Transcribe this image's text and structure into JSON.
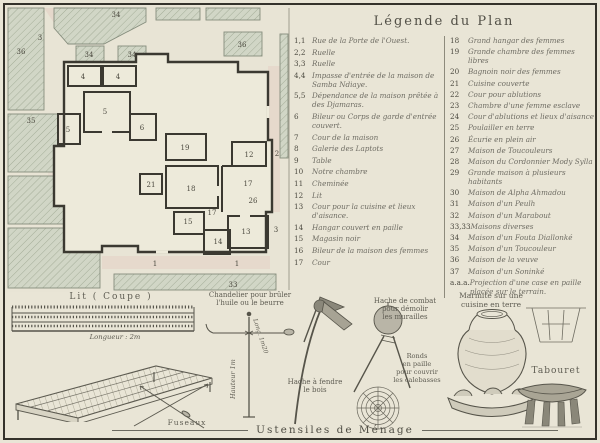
{
  "colors": {
    "paper": "#e9e5d6",
    "frame_ink": "#34322b",
    "legend_ink": "#6f6d64",
    "plan_wall_ink": "#3b3931",
    "hatch_fill": "#d1d6c6",
    "hatch_line": "#9fa893",
    "street_pink": "#e3cfc4"
  },
  "legend": {
    "title": "Légende du Plan",
    "left": [
      {
        "num": "1,1",
        "text": "Rue de la Porte de l'Ouest."
      },
      {
        "num": "2,2",
        "text": "Ruelle"
      },
      {
        "num": "3,3",
        "text": "Ruelle"
      },
      {
        "num": "4,4",
        "text": "Impasse d'entrée de la maison de Samba Ndiaye."
      },
      {
        "num": "5,5",
        "text": "Dépendance de la maison prêtée à des Djamaras."
      },
      {
        "num": "6",
        "text": "Bileur ou Corps de garde d'entrée couvert."
      },
      {
        "num": "7",
        "text": "Cour de la maison"
      },
      {
        "num": "8",
        "text": "Galerie des Laptots"
      },
      {
        "num": "9",
        "text": "Table"
      },
      {
        "num": "10",
        "text": "Notre chambre"
      },
      {
        "num": "11",
        "text": "Cheminée"
      },
      {
        "num": "12",
        "text": "Lit"
      },
      {
        "num": "13",
        "text": "Cour pour la cuisine et lieux d'aisance."
      },
      {
        "num": "14",
        "text": "Hangar couvert en paille"
      },
      {
        "num": "15",
        "text": "Magasin noir"
      },
      {
        "num": "16",
        "text": "Bileur de la maison des femmes"
      },
      {
        "num": "17",
        "text": "Cour"
      }
    ],
    "right": [
      {
        "num": "18",
        "text": "Grand hangar des femmes"
      },
      {
        "num": "19",
        "text": "Grande chambre des femmes libres"
      },
      {
        "num": "20",
        "text": "Bagnoin noir des femmes"
      },
      {
        "num": "21",
        "text": "Cuisine couverte"
      },
      {
        "num": "22",
        "text": "Cour pour ablutions"
      },
      {
        "num": "23",
        "text": "Chambre d'une femme esclave"
      },
      {
        "num": "24",
        "text": "Cour d'ablutions et lieux d'aisance"
      },
      {
        "num": "25",
        "text": "Poulailler en terre"
      },
      {
        "num": "26",
        "text": "Écurie en plein air"
      },
      {
        "num": "27",
        "text": "Maison de Toucouleurs"
      },
      {
        "num": "28",
        "text": "Maison du Cordonnier Mody Sylla"
      },
      {
        "num": "29",
        "text": "Grande maison à plusieurs habitants"
      },
      {
        "num": "30",
        "text": "Maison de Alpha Ahmadou"
      },
      {
        "num": "31",
        "text": "Maison d'un Peulh"
      },
      {
        "num": "32",
        "text": "Maison d'un Marabout"
      },
      {
        "num": "33,33",
        "text": "Maisons diverses"
      },
      {
        "num": "34",
        "text": "Maison d'un Fouta Diallonké"
      },
      {
        "num": "35",
        "text": "Maison d'un Toucouleur"
      },
      {
        "num": "36",
        "text": "Maison de la veuve"
      },
      {
        "num": "37",
        "text": "Maison d'un Soninké"
      },
      {
        "num": "a.a.a.",
        "text": "Projection d'une case en paille placée sur le terrain."
      }
    ]
  },
  "plan": {
    "numbers": [
      {
        "label": "36"
      },
      {
        "label": "3"
      },
      {
        "label": "34"
      },
      {
        "label": "34"
      },
      {
        "label": "34"
      },
      {
        "label": "36"
      },
      {
        "label": "35"
      },
      {
        "label": "4"
      },
      {
        "label": "4"
      },
      {
        "label": "5"
      },
      {
        "label": "5"
      },
      {
        "label": "6"
      },
      {
        "label": "19"
      },
      {
        "label": "21"
      },
      {
        "label": "18"
      },
      {
        "label": "12"
      },
      {
        "label": "2"
      },
      {
        "label": "17"
      },
      {
        "label": "26"
      },
      {
        "label": "17"
      },
      {
        "label": "15"
      },
      {
        "label": "13"
      },
      {
        "label": "14"
      },
      {
        "label": "3"
      },
      {
        "label": "1"
      },
      {
        "label": "1"
      },
      {
        "label": "33"
      }
    ]
  },
  "utensils": {
    "section_title": "Ustensiles de Ménage",
    "bed": {
      "title": "Lit ( Coupe )",
      "length_label": "Longueur : 2m",
      "spindles_label": "Fuseaux"
    },
    "candlestick": {
      "caption_line1": "Chandelier pour brûler",
      "caption_line2": "l'huile ou le beurre",
      "height_label": "Hauteur 1m"
    },
    "wood_axe": {
      "caption_line1": "Hache à fendre",
      "caption_line2": "le bois",
      "length_label": "Long. 1m20"
    },
    "combat_axe": {
      "caption_line1": "Hache de combat",
      "caption_line2": "pour démolir",
      "caption_line3": "les murailles"
    },
    "straw_rings": {
      "caption_line1": "Ronds",
      "caption_line2": "en paille",
      "caption_line3": "pour couvrir",
      "caption_line4": "les calebasses"
    },
    "pot": {
      "caption_line1": "Marmite sur une",
      "caption_line2": "cuisine en terre"
    },
    "stool": {
      "label": "Tabouret"
    }
  }
}
